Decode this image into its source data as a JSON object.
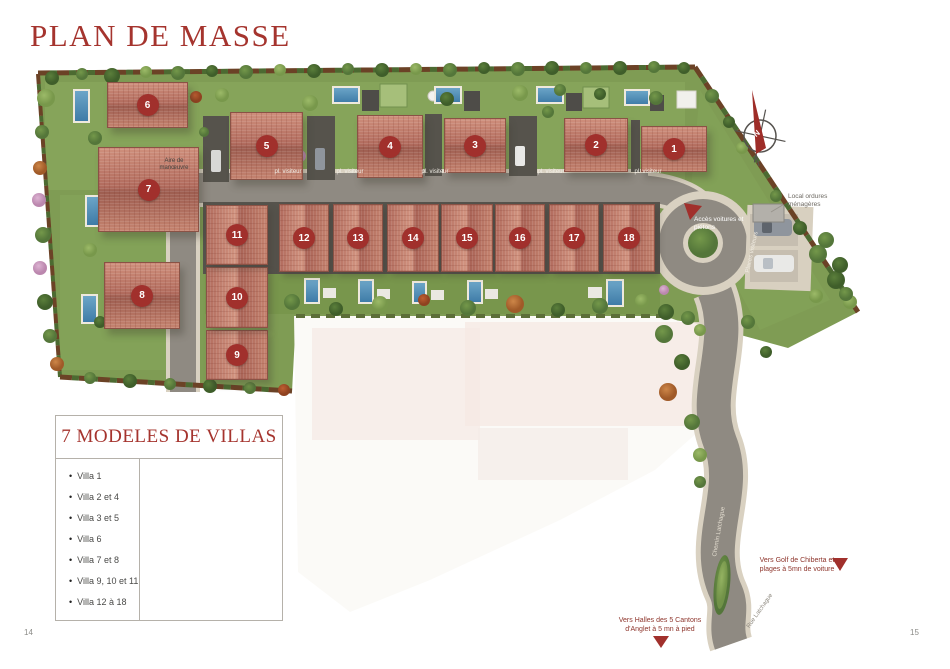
{
  "page": {
    "title": "PLAN DE MASSE",
    "page_number_left": "14",
    "page_number_right": "15"
  },
  "legend": {
    "title": "7 MODELES DE VILLAS",
    "items": [
      "Villa 1",
      "Villa 2 et 4",
      "Villa 3 et 5",
      "Villa 6",
      "Villa 7 et 8",
      "Villa 9, 10 et 11",
      "Villa 12 à 18"
    ]
  },
  "plan": {
    "villas": [
      "1",
      "2",
      "3",
      "4",
      "5",
      "6",
      "7",
      "8",
      "9",
      "10",
      "11",
      "12",
      "13",
      "14",
      "15",
      "16",
      "17",
      "18"
    ],
    "labels": {
      "visitor_parking": "pl. visiteur",
      "maneuver": "Aire de manœuvre",
      "places_visitors": "Places visiteurs",
      "access": "Accès voitures et piétons",
      "waste": "Local ordures ménagères",
      "street_chemin": "Chemin Latchague",
      "street_rue": "Rue Latchague",
      "to_golf": "Vers Golf de Chiberta et plages à 5mn de voiture",
      "to_halles": "Vers Halles des 5 Cantons d'Anglet à 5 mn à pied",
      "north": "N"
    },
    "colors": {
      "accent_red": "#A1302C",
      "roof": "#BB7365",
      "grass": "#7F9C54",
      "road": "#8F8A82",
      "sidewalk": "#D9D1C1",
      "pool": "#4B84AD"
    }
  }
}
